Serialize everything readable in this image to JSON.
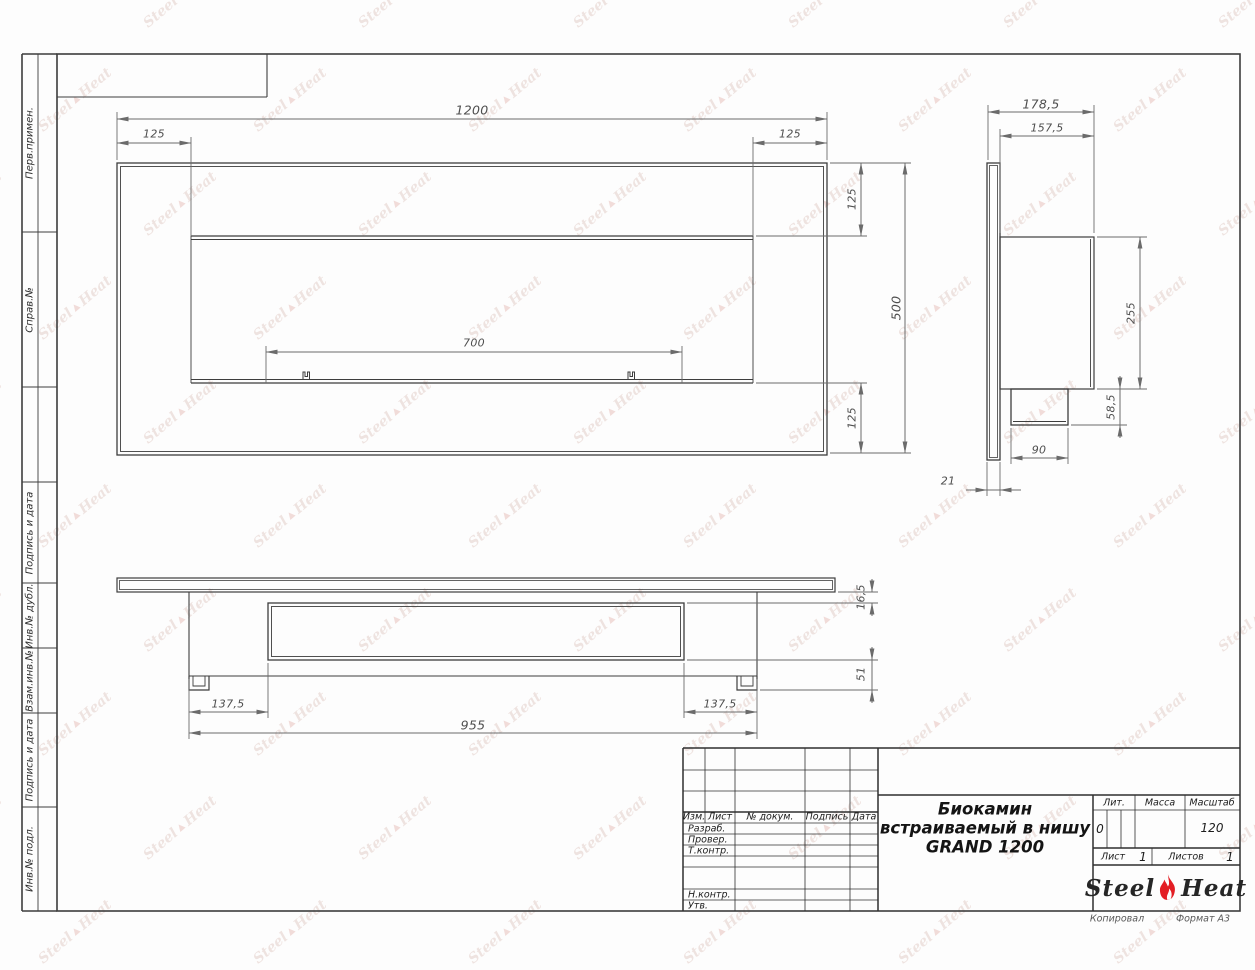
{
  "left_strip": [
    "Перв.примен.",
    "Справ.№",
    "Подпись и дата",
    "Инв.№ дубл.",
    "Взам.инв.№",
    "Подпись и дата",
    "Инв.№ подл."
  ],
  "front_view": {
    "dim_width": "1200",
    "dim_margin_left": "125",
    "dim_margin_right": "125",
    "dim_opening": "700",
    "dim_inner_top": "125",
    "dim_height": "500",
    "dim_inner_bottom": "125"
  },
  "side_view": {
    "dim_total_depth": "178,5",
    "dim_box_depth": "157,5",
    "dim_box_height": "255",
    "dim_bracket_height": "58,5",
    "dim_bracket_width": "90",
    "dim_panel_thickness": "21"
  },
  "bottom_view": {
    "dim_left_offset": "137,5",
    "dim_body_width": "955",
    "dim_right_offset": "137,5",
    "dim_plate_gap": "16,5",
    "dim_depth": "51"
  },
  "title_block": {
    "rev_headers": {
      "izm": "Изм.",
      "sheet": "Лист",
      "doc": "№ докум.",
      "sign": "Подпись",
      "date": "Дата"
    },
    "roles": {
      "developed": "Разраб.",
      "checked": "Провер.",
      "tech_control": "Т.контр.",
      "norm_control": "Н.контр.",
      "approved": "Утв."
    },
    "title_lines": [
      "Биокамин",
      "встраиваемый в нишу",
      "GRAND 1200"
    ],
    "lit": {
      "label": "Лит.",
      "value": "0"
    },
    "mass": {
      "label": "Масса",
      "value": ""
    },
    "scale": {
      "label": "Масштаб",
      "value": "120"
    },
    "sheet": {
      "label": "Лист",
      "value": "1"
    },
    "sheets": {
      "label": "Листов",
      "value": "1"
    },
    "logo": {
      "word1": "Steel",
      "word2": "Heat"
    }
  },
  "footer": {
    "copied": "Копировал",
    "format": "Формат А3"
  },
  "watermark": {
    "word1": "Steel",
    "word2": "Heat"
  },
  "colors": {
    "line_main": "#3d3d3d",
    "line_dim": "#6b6b6b",
    "logo_flame": "#e31e24",
    "watermark": "#cfa89e"
  }
}
